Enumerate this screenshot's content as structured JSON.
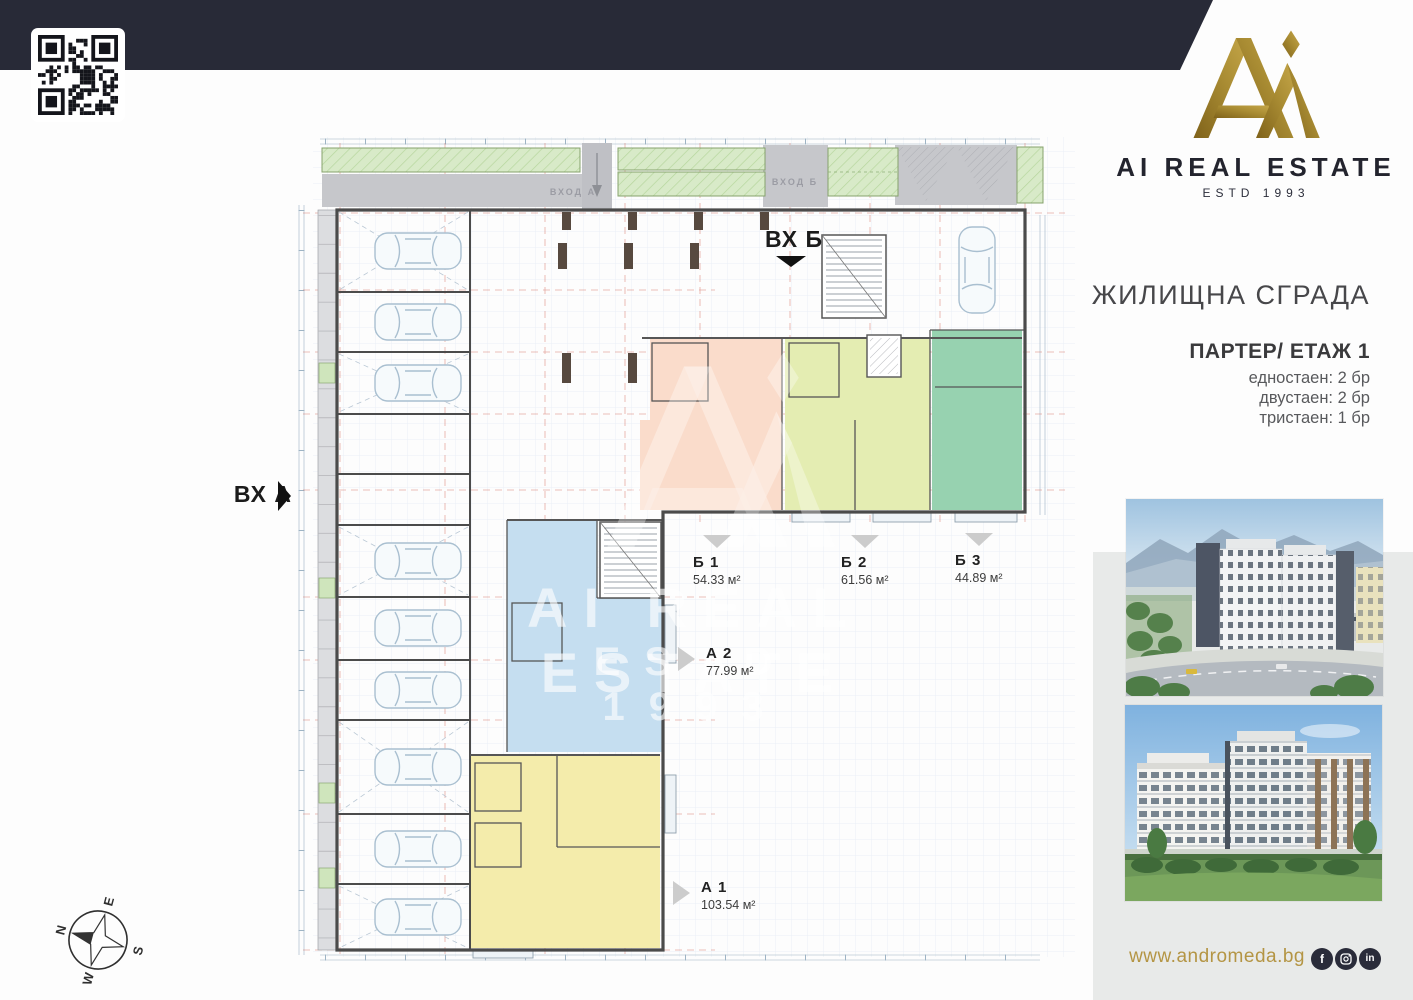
{
  "brand": {
    "name": "AI REAL ESTATE",
    "estd": "ESTD 1993",
    "gold": "#9a7d28",
    "navy": "#282a37"
  },
  "info": {
    "building_title": "ЖИЛИЩНА СГРАДА",
    "floor_title": "ПАРТЕР/ ЕТАЖ 1",
    "stats": [
      "едностаен: 2 бр",
      "двустаен: 2 бр",
      "тристаен: 1 бр"
    ]
  },
  "entrances": {
    "a": "ВХ А",
    "b": "ВХ Б"
  },
  "plan": {
    "walkway_labels": {
      "vhod_a": "ВХОД А",
      "vhod_b": "ВХОД Б"
    },
    "units": [
      {
        "id": "Б 1",
        "area": "54.33 м²",
        "color": "#f6b394",
        "fill": "#fadccb"
      },
      {
        "id": "Б 2",
        "area": "61.56 м²",
        "color": "#cede8b",
        "fill": "#e4edb2"
      },
      {
        "id": "Б 3",
        "area": "44.89 м²",
        "color": "#7fc8a3",
        "fill": "#97d2b0"
      },
      {
        "id": "А 2",
        "area": "77.99 м²",
        "color": "#a7d2ec",
        "fill": "#c5def0"
      },
      {
        "id": "А 1",
        "area": "103.54 м²",
        "color": "#efe092",
        "fill": "#f4ecab"
      }
    ],
    "watermark": {
      "line1": "AI REAL ESTATE",
      "line2": "ESTD 1993"
    }
  },
  "compass": {
    "n": "N",
    "e": "E",
    "s": "S",
    "w": "W"
  },
  "footer": {
    "website": "www.andromeda.bg",
    "social": [
      "facebook",
      "instagram",
      "linkedin"
    ]
  }
}
